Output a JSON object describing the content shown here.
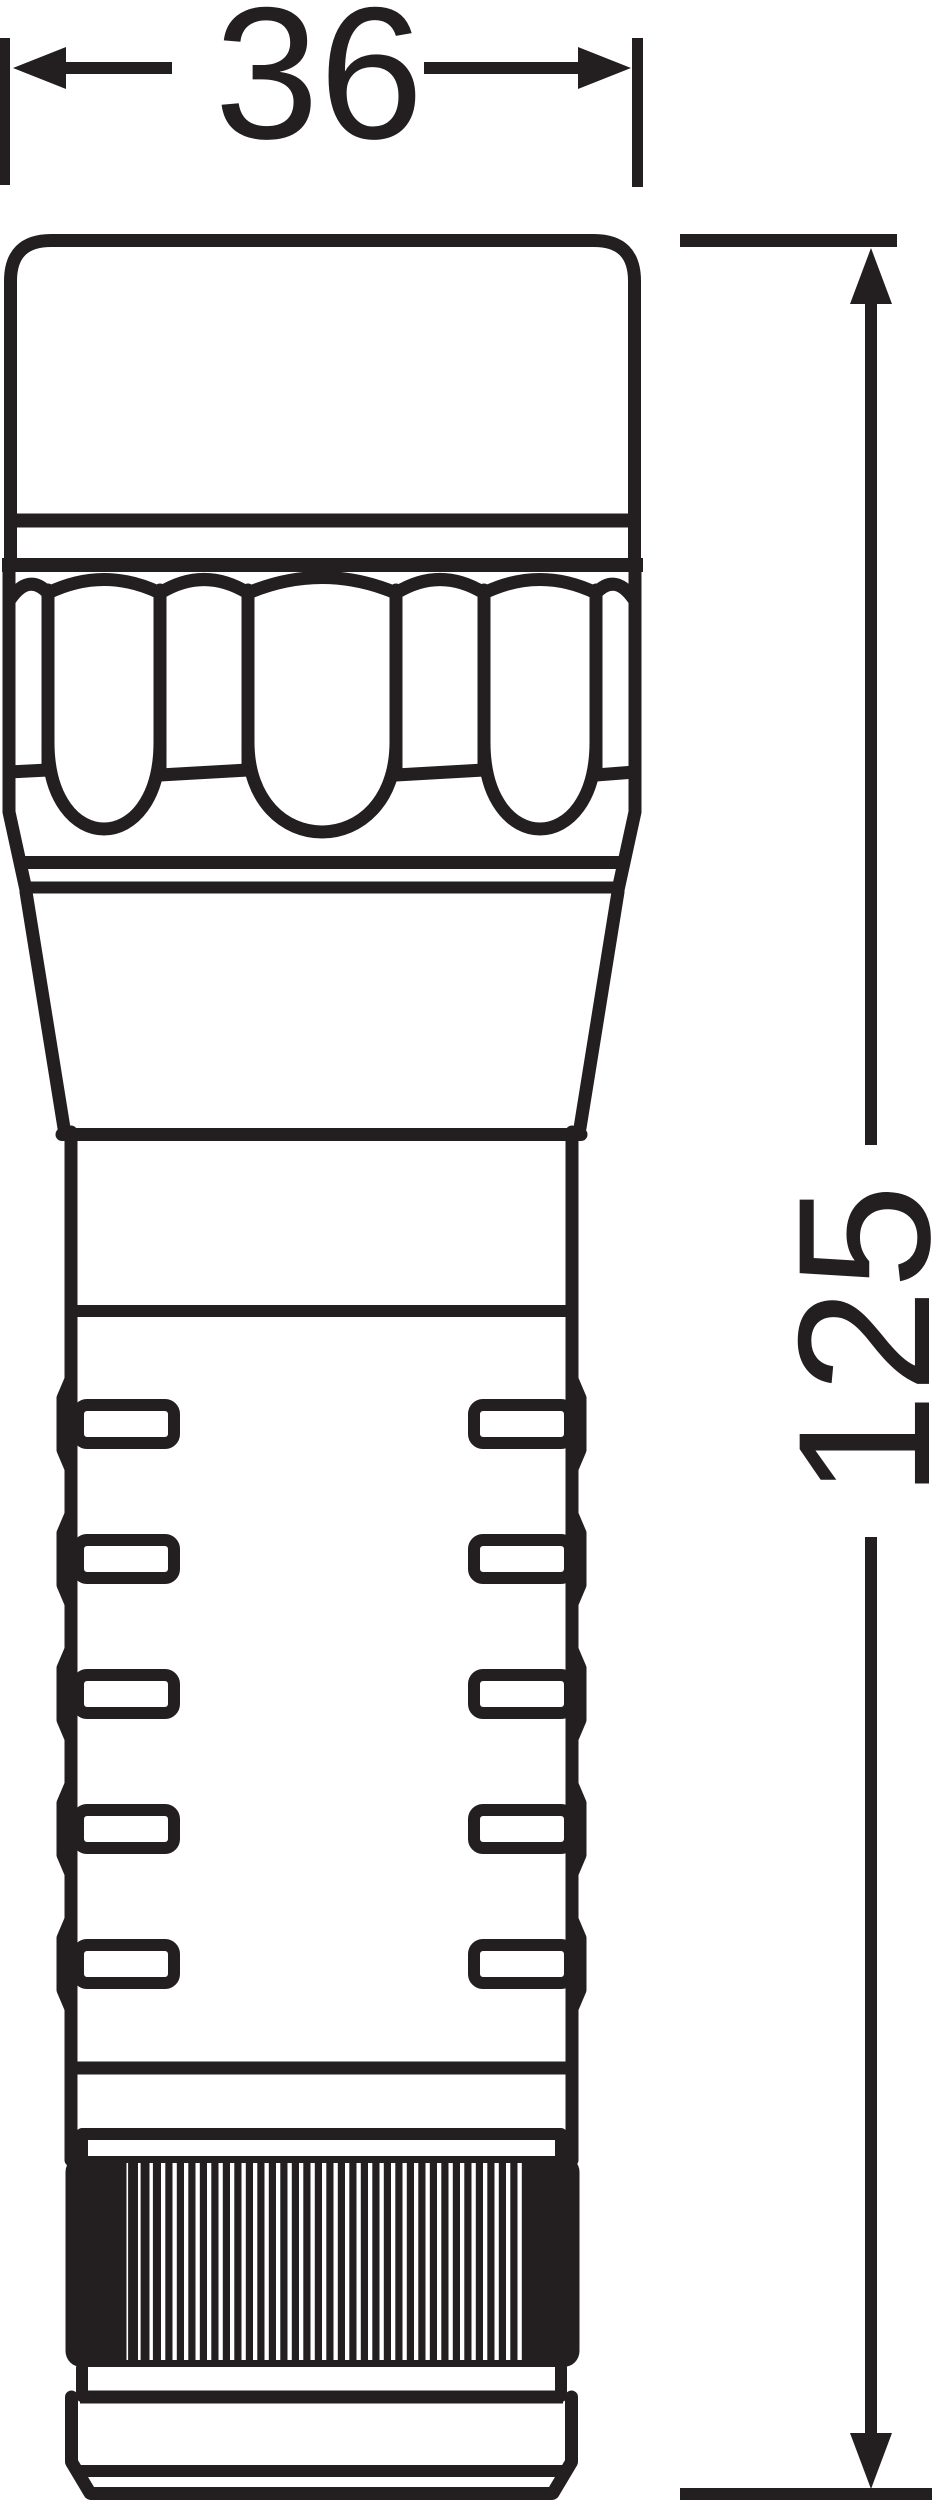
{
  "drawing": {
    "background_color": "#ffffff",
    "ink_color": "#231f20",
    "dimension_width": {
      "label": "36"
    },
    "dimension_height": {
      "label": "125"
    },
    "features": {
      "grip_slot_rows": 5,
      "bezel_flutes": 3,
      "knurl_stripe_count": 35
    }
  }
}
